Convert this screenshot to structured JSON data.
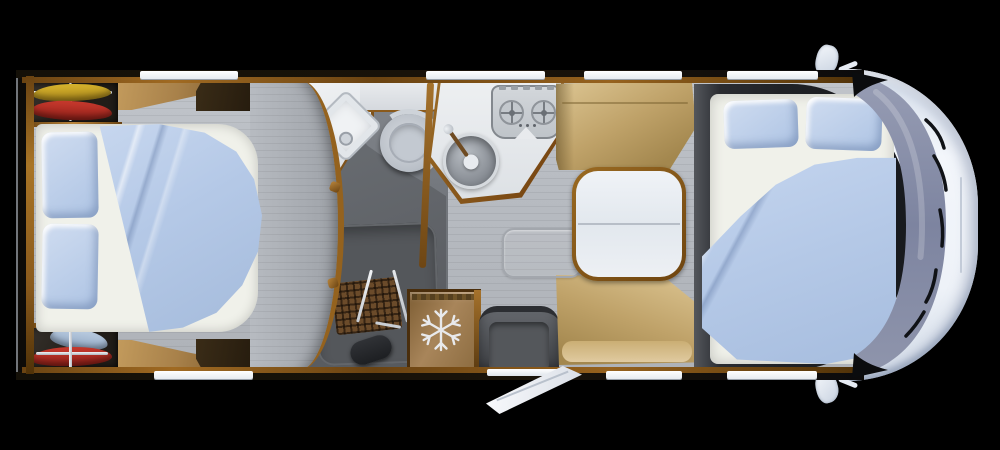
{
  "palette": {
    "bg": "#000000",
    "shell": "#0d0b08",
    "edge": "#71757a",
    "wood": "#8a5a1c",
    "wood_light": "#b9853c",
    "wood_dark": "#5a3a10",
    "floor": "#b7bbc1",
    "floor_line": "#a6aab0",
    "bath_floor": "#73777d",
    "shower": "#5e6166",
    "tray": "#54575b",
    "mat": "#6b4b2a",
    "sheet": "#f0f1ea",
    "pillow": "#b9cde9",
    "duvet": "#b5c9e7",
    "duvet_deep": "#9db4d8",
    "seat": "#bfa269",
    "seat_dark": "#8a6d3a",
    "seat_light": "#d8c08c",
    "table_top": "#edf0f5",
    "counter": "#e8eaed",
    "steel": "#c6cbd1",
    "steel_dark": "#8d9298",
    "toilet": "#c3c9d1",
    "fridge": "#9a7848",
    "fridge_dark": "#4a2e0c",
    "snow": "#e8e9ec",
    "step": "#45484c",
    "step_dark": "#2c2e32",
    "cab": "#e9eef6",
    "cab_shadow": "#c4cedd",
    "glass": "#8a90a8",
    "glass_dark": "#757c98",
    "red": "#b52c22",
    "yellow": "#c8a322",
    "blue_garment": "#a8bdd6",
    "window": "#f4f6f9",
    "dark_zone": "#202226",
    "wardrobe": "#2b2620"
  },
  "floorplan": {
    "view": "top-down",
    "vehicle": "motorhome",
    "rooms": [
      {
        "name": "rear-bedroom",
        "furniture": [
          "wardrobe-top",
          "wardrobe-bottom",
          "double-bed",
          "pillow",
          "pillow",
          "duvet",
          "overhead-locker",
          "overhead-locker"
        ]
      },
      {
        "name": "bathroom",
        "furniture": [
          "washbasin",
          "toilet",
          "shower-tray",
          "shower-mat",
          "towel-rail",
          "shower-head",
          "curved-partition"
        ]
      },
      {
        "name": "kitchen",
        "furniture": [
          "two-burner-hob",
          "round-sink",
          "worktop",
          "refrigerator"
        ]
      },
      {
        "name": "dinette",
        "furniture": [
          "bench-seat",
          "table",
          "bench-seat",
          "floor-hatch"
        ]
      },
      {
        "name": "front-bedroom",
        "furniture": [
          "double-bed",
          "pillow",
          "pillow",
          "duvet"
        ]
      },
      {
        "name": "cab",
        "furniture": [
          "windshield",
          "side-mirror",
          "side-mirror"
        ]
      }
    ],
    "openings": {
      "windows_top": 4,
      "windows_bottom": 3,
      "entry_door": "open"
    },
    "windows_top_px": [
      [
        140,
        98
      ],
      [
        426,
        119
      ],
      [
        584,
        98
      ],
      [
        727,
        91
      ]
    ],
    "windows_bottom_px": [
      [
        154,
        99
      ],
      [
        606,
        76
      ],
      [
        727,
        90
      ]
    ]
  }
}
